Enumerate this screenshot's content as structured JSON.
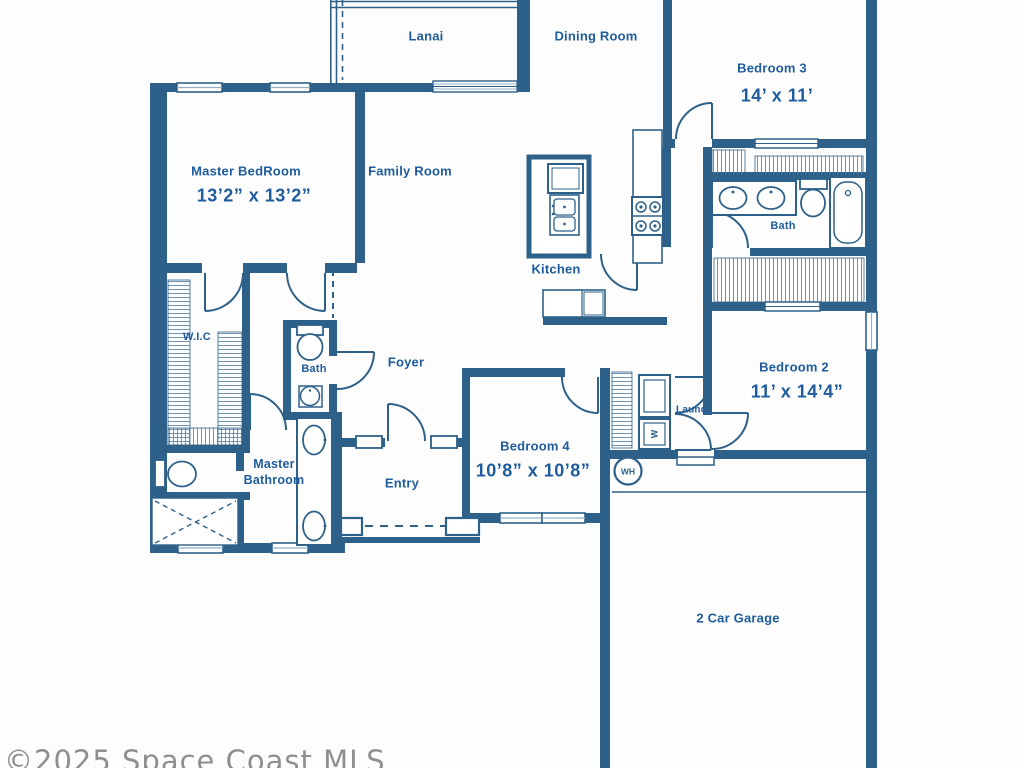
{
  "floorplan": {
    "watermark": "©2025 Space Coast MLS",
    "colors": {
      "wall": "#2e6189",
      "label_text": "#1f5c9d",
      "window_line": "#8fb0c9",
      "watermark": "#8f8f8f",
      "background": "#fdfdfd"
    },
    "rooms": {
      "lanai": {
        "label": "Lanai"
      },
      "dining_room": {
        "label": "Dining Room"
      },
      "bedroom3": {
        "label": "Bedroom 3",
        "dims": "14’ x 11’"
      },
      "master_bedroom": {
        "label": "Master BedRoom",
        "dims": "13’2” x 13’2”"
      },
      "family_room": {
        "label": "Family Room"
      },
      "kitchen": {
        "label": "Kitchen"
      },
      "bath_main": {
        "label": "Bath"
      },
      "wic": {
        "label": "W.I.C"
      },
      "bath_half": {
        "label": "Bath"
      },
      "foyer": {
        "label": "Foyer"
      },
      "bedroom2": {
        "label": "Bedroom 2",
        "dims": "11’ x 14’4”"
      },
      "master_bathroom": {
        "label_line1": "Master",
        "label_line2": "Bathroom"
      },
      "entry": {
        "label": "Entry"
      },
      "bedroom4": {
        "label": "Bedroom 4",
        "dims": "10’8” x 10’8”"
      },
      "laundry": {
        "label": "Laund."
      },
      "garage": {
        "label": "2 Car Garage"
      }
    },
    "fixtures": {
      "water_heater": {
        "label": "WH"
      },
      "washer": {
        "label": "W"
      }
    }
  }
}
